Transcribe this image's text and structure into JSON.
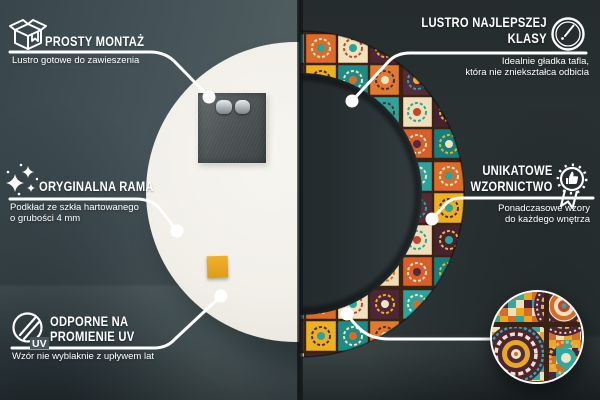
{
  "meta": {
    "type": "product-infographic",
    "language": "pl"
  },
  "colors": {
    "wall_left": "#46545a",
    "wall_right": "#2b3334",
    "line_and_text": "#ffffff",
    "mirror_back": "#f3f1ea",
    "mount_plate": "#4c5354",
    "accent_pad": "#e9a71f",
    "tile_teal": "#2aa49c",
    "tile_orange": "#dd6b28",
    "tile_yellow": "#edb021",
    "tile_maroon": "#4e2737",
    "tile_cream": "#f0e2bd",
    "tile_grout": "#3a2214"
  },
  "scene": {
    "left_view": "mirror-back-view",
    "right_view": "mirror-front-view",
    "detail": "pattern-detail-zoom"
  },
  "callouts": {
    "simple_mount": {
      "icon": "package-icon",
      "title": "PROSTY MONTAŻ",
      "subtitle": "Lustro gotowe do zawieszenia"
    },
    "original_frame": {
      "icon": "sparkles-icon",
      "title": "ORYGINALNA RAMA",
      "subtitle_line1": "Podkład ze szkła hartowanego",
      "subtitle_line2": "o grubości 4 mm"
    },
    "uv_resistant": {
      "icon": "uv-shield-icon",
      "icon_label": "UV",
      "title_line1": "ODPORNE NA",
      "title_line2": "PROMIENIE UV",
      "subtitle": "Wzór nie wyblaknie z upływem lat"
    },
    "top_class": {
      "icon": "mirror-shine-icon",
      "title_line1": "LUSTRO NAJLEPSZEJ",
      "title_line2": "KLASY",
      "subtitle_line1": "Idealnie gładka tafla,",
      "subtitle_line2": "która nie zniekształca odbicia"
    },
    "unique_design": {
      "icon": "award-badge-icon",
      "title_line1": "UNIKATOWE",
      "title_line2": "WZORNICTWO",
      "subtitle_line1": "Ponadczasowe wzory",
      "subtitle_line2": "do każdego wnętrza"
    }
  }
}
